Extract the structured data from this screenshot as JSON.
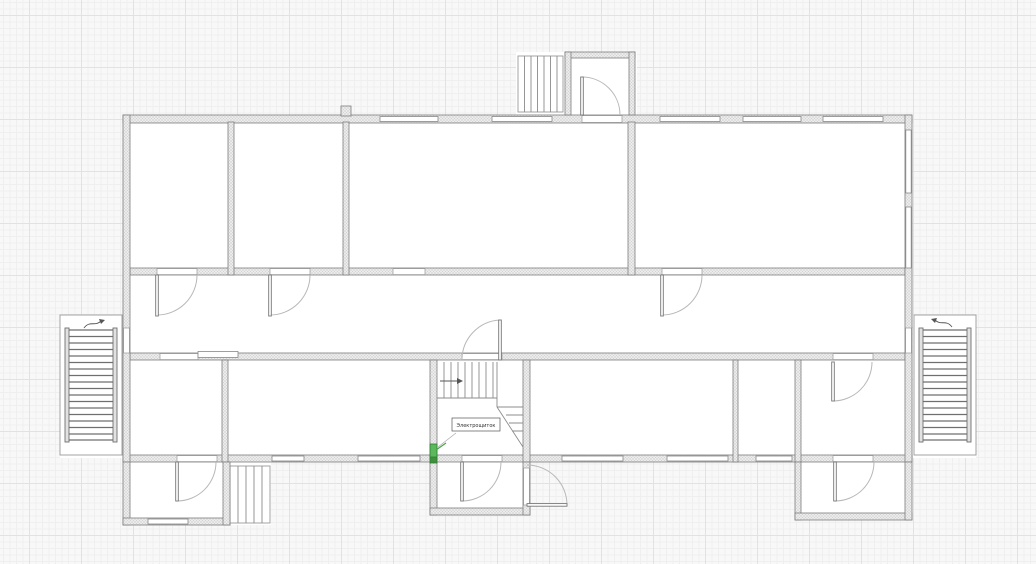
{
  "plan": {
    "equipment_label": "Электрощиток",
    "colors": {
      "canvas_bg": "#f8f8f8",
      "grid_minor": "#efefef",
      "grid_major": "#e2e2e2",
      "wall_fill": "#ececec",
      "wall_hatch": "#d0d0d0",
      "wall_stroke": "#7d7d7d",
      "door_arc": "#b8b8b8",
      "door_leaf": "#777777",
      "stair_line": "#8c8c8c",
      "selected_green": "#5cb85c",
      "selected_green_dark": "#2e7d32"
    }
  }
}
